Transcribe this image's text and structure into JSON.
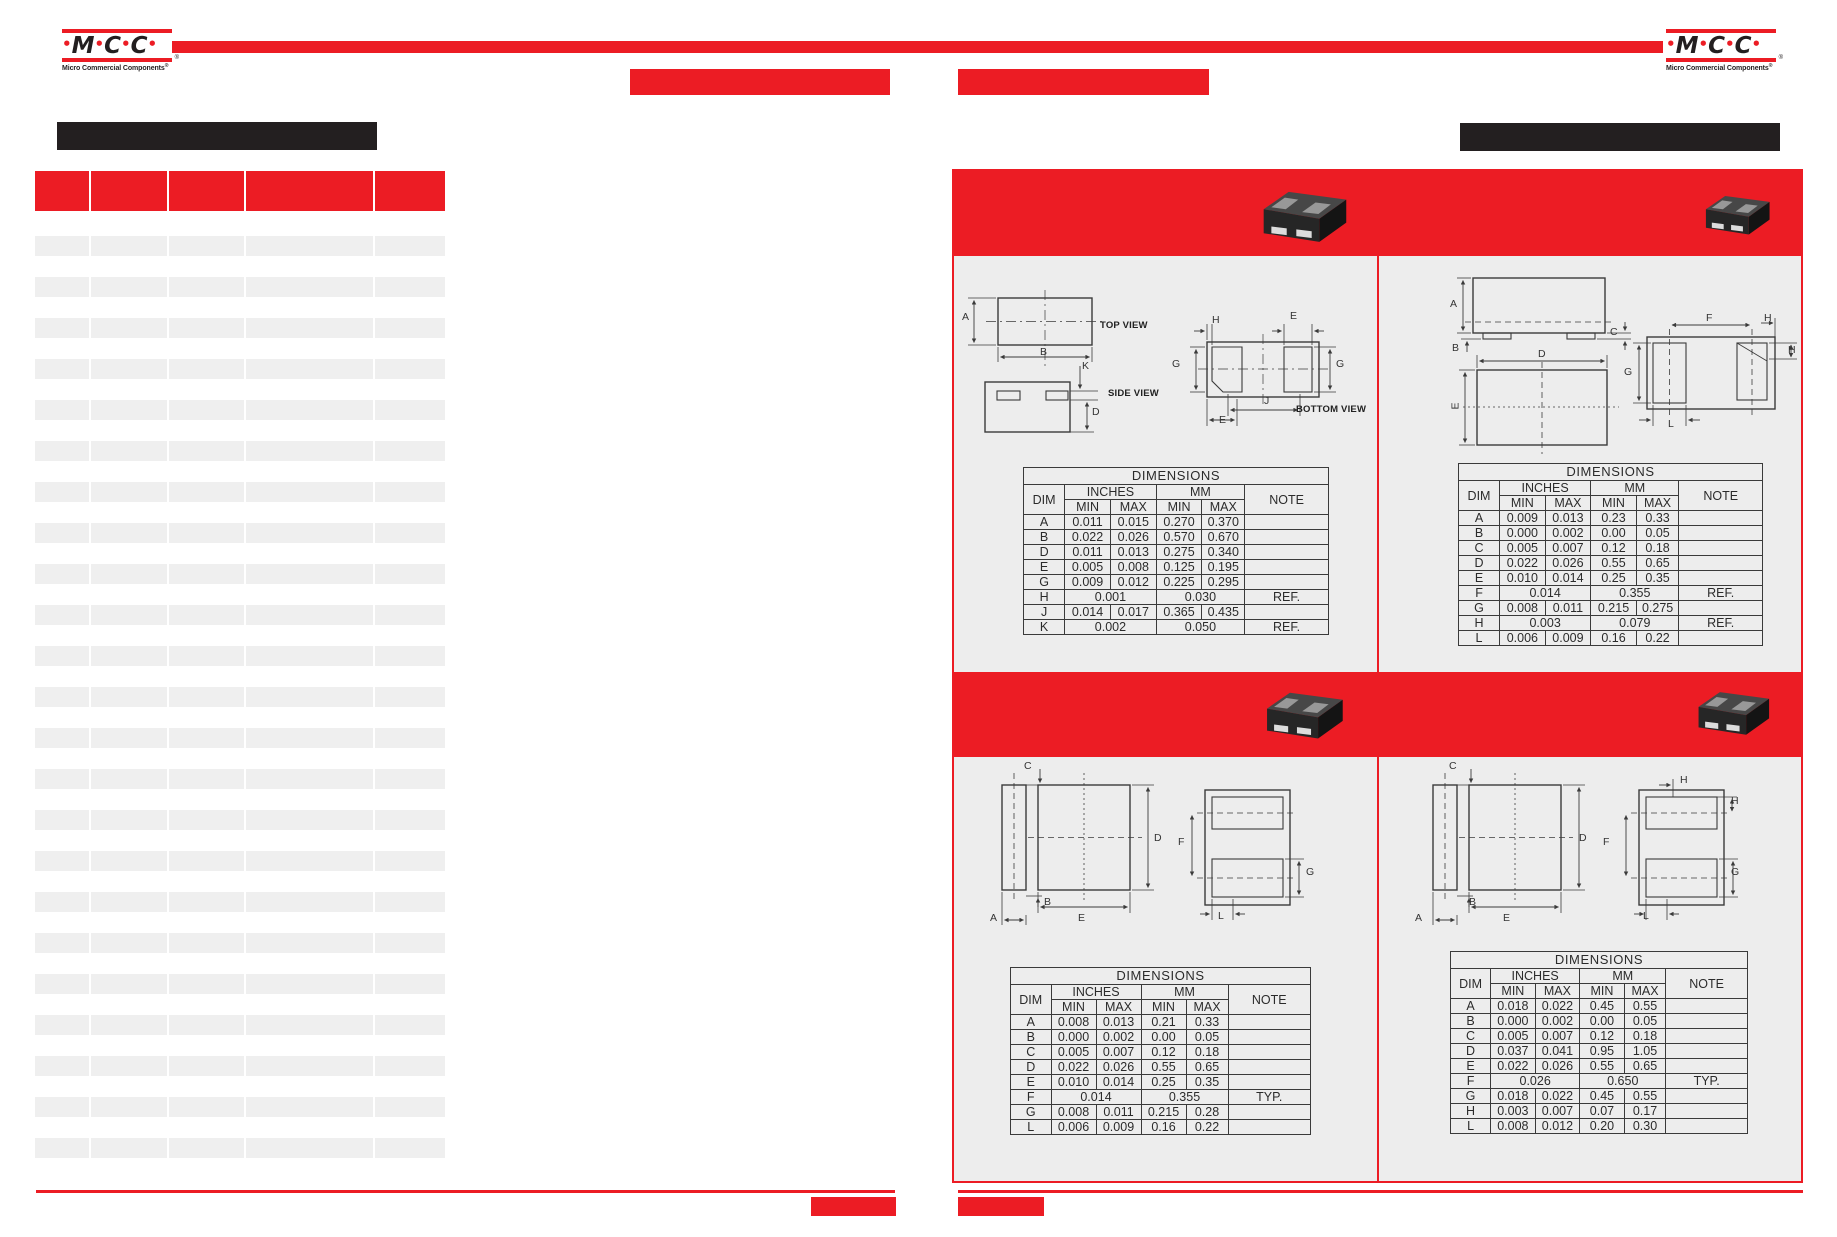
{
  "brand": {
    "wordmark": [
      {
        "t": "•",
        "red": 1
      },
      {
        "t": "M"
      },
      {
        "t": "•",
        "red": 1
      },
      {
        "t": "C"
      },
      {
        "t": "•",
        "red": 1
      },
      {
        "t": "C"
      },
      {
        "t": "•",
        "red": 1
      }
    ],
    "tagline": "Micro Commercial Components",
    "reg": "®"
  },
  "left_table": {
    "row_count": 23,
    "columns": 5
  },
  "dims_tables": {
    "q1": {
      "title": "DIMENSIONS",
      "dim_header": "DIM",
      "group_headers": [
        "INCHES",
        "MM"
      ],
      "sub_headers": [
        "MIN",
        "MAX",
        "MIN",
        "MAX"
      ],
      "note_header": "NOTE",
      "rows": [
        {
          "dim": "A",
          "inches": [
            "0.011",
            "0.015"
          ],
          "mm": [
            "0.270",
            "0.370"
          ],
          "note": ""
        },
        {
          "dim": "B",
          "inches": [
            "0.022",
            "0.026"
          ],
          "mm": [
            "0.570",
            "0.670"
          ],
          "note": ""
        },
        {
          "dim": "D",
          "inches": [
            "0.011",
            "0.013"
          ],
          "mm": [
            "0.275",
            "0.340"
          ],
          "note": ""
        },
        {
          "dim": "E",
          "inches": [
            "0.005",
            "0.008"
          ],
          "mm": [
            "0.125",
            "0.195"
          ],
          "note": ""
        },
        {
          "dim": "G",
          "inches": [
            "0.009",
            "0.012"
          ],
          "mm": [
            "0.225",
            "0.295"
          ],
          "note": ""
        },
        {
          "dim": "H",
          "inches_span": "0.001",
          "mm_span": "0.030",
          "note": "REF."
        },
        {
          "dim": "J",
          "inches": [
            "0.014",
            "0.017"
          ],
          "mm": [
            "0.365",
            "0.435"
          ],
          "note": ""
        },
        {
          "dim": "K",
          "inches_span": "0.002",
          "mm_span": "0.050",
          "note": "REF."
        }
      ]
    },
    "q2": {
      "title": "DIMENSIONS",
      "dim_header": "DIM",
      "group_headers": [
        "INCHES",
        "MM"
      ],
      "sub_headers": [
        "MIN",
        "MAX",
        "MIN",
        "MAX"
      ],
      "note_header": "NOTE",
      "rows": [
        {
          "dim": "A",
          "inches": [
            "0.009",
            "0.013"
          ],
          "mm": [
            "0.23",
            "0.33"
          ],
          "note": ""
        },
        {
          "dim": "B",
          "inches": [
            "0.000",
            "0.002"
          ],
          "mm": [
            "0.00",
            "0.05"
          ],
          "note": ""
        },
        {
          "dim": "C",
          "inches": [
            "0.005",
            "0.007"
          ],
          "mm": [
            "0.12",
            "0.18"
          ],
          "note": ""
        },
        {
          "dim": "D",
          "inches": [
            "0.022",
            "0.026"
          ],
          "mm": [
            "0.55",
            "0.65"
          ],
          "note": ""
        },
        {
          "dim": "E",
          "inches": [
            "0.010",
            "0.014"
          ],
          "mm": [
            "0.25",
            "0.35"
          ],
          "note": ""
        },
        {
          "dim": "F",
          "inches_span": "0.014",
          "mm_span": "0.355",
          "note": "REF."
        },
        {
          "dim": "G",
          "inches": [
            "0.008",
            "0.011"
          ],
          "mm": [
            "0.215",
            "0.275"
          ],
          "note": ""
        },
        {
          "dim": "H",
          "inches_span": "0.003",
          "mm_span": "0.079",
          "note": "REF."
        },
        {
          "dim": "L",
          "inches": [
            "0.006",
            "0.009"
          ],
          "mm": [
            "0.16",
            "0.22"
          ],
          "note": ""
        }
      ]
    },
    "q3": {
      "title": "DIMENSIONS",
      "dim_header": "DIM",
      "group_headers": [
        "INCHES",
        "MM"
      ],
      "sub_headers": [
        "MIN",
        "MAX",
        "MIN",
        "MAX"
      ],
      "note_header": "NOTE",
      "rows": [
        {
          "dim": "A",
          "inches": [
            "0.008",
            "0.013"
          ],
          "mm": [
            "0.21",
            "0.33"
          ],
          "note": ""
        },
        {
          "dim": "B",
          "inches": [
            "0.000",
            "0.002"
          ],
          "mm": [
            "0.00",
            "0.05"
          ],
          "note": ""
        },
        {
          "dim": "C",
          "inches": [
            "0.005",
            "0.007"
          ],
          "mm": [
            "0.12",
            "0.18"
          ],
          "note": ""
        },
        {
          "dim": "D",
          "inches": [
            "0.022",
            "0.026"
          ],
          "mm": [
            "0.55",
            "0.65"
          ],
          "note": ""
        },
        {
          "dim": "E",
          "inches": [
            "0.010",
            "0.014"
          ],
          "mm": [
            "0.25",
            "0.35"
          ],
          "note": ""
        },
        {
          "dim": "F",
          "inches_span": "0.014",
          "mm_span": "0.355",
          "note": "TYP."
        },
        {
          "dim": "G",
          "inches": [
            "0.008",
            "0.011"
          ],
          "mm": [
            "0.215",
            "0.28"
          ],
          "note": ""
        },
        {
          "dim": "L",
          "inches": [
            "0.006",
            "0.009"
          ],
          "mm": [
            "0.16",
            "0.22"
          ],
          "note": ""
        }
      ]
    },
    "q4": {
      "title": "DIMENSIONS",
      "dim_header": "DIM",
      "group_headers": [
        "INCHES",
        "MM"
      ],
      "sub_headers": [
        "MIN",
        "MAX",
        "MIN",
        "MAX"
      ],
      "note_header": "NOTE",
      "rows": [
        {
          "dim": "A",
          "inches": [
            "0.018",
            "0.022"
          ],
          "mm": [
            "0.45",
            "0.55"
          ],
          "note": ""
        },
        {
          "dim": "B",
          "inches": [
            "0.000",
            "0.002"
          ],
          "mm": [
            "0.00",
            "0.05"
          ],
          "note": ""
        },
        {
          "dim": "C",
          "inches": [
            "0.005",
            "0.007"
          ],
          "mm": [
            "0.12",
            "0.18"
          ],
          "note": ""
        },
        {
          "dim": "D",
          "inches": [
            "0.037",
            "0.041"
          ],
          "mm": [
            "0.95",
            "1.05"
          ],
          "note": ""
        },
        {
          "dim": "E",
          "inches": [
            "0.022",
            "0.026"
          ],
          "mm": [
            "0.55",
            "0.65"
          ],
          "note": ""
        },
        {
          "dim": "F",
          "inches_span": "0.026",
          "mm_span": "0.650",
          "note": "TYP."
        },
        {
          "dim": "G",
          "inches": [
            "0.018",
            "0.022"
          ],
          "mm": [
            "0.45",
            "0.55"
          ],
          "note": ""
        },
        {
          "dim": "H",
          "inches": [
            "0.003",
            "0.007"
          ],
          "mm": [
            "0.07",
            "0.17"
          ],
          "note": ""
        },
        {
          "dim": "L",
          "inches": [
            "0.008",
            "0.012"
          ],
          "mm": [
            "0.20",
            "0.30"
          ],
          "note": ""
        }
      ]
    }
  },
  "drawing_labels": {
    "q1": [
      {
        "t": "A",
        "x": 962,
        "y": 311
      },
      {
        "t": "B",
        "x": 1040,
        "y": 346
      },
      {
        "t": "TOP VIEW",
        "x": 1100,
        "y": 320,
        "v": 1
      },
      {
        "t": "K",
        "x": 1082,
        "y": 360
      },
      {
        "t": "D",
        "x": 1092,
        "y": 406
      },
      {
        "t": "SIDE VIEW",
        "x": 1108,
        "y": 388,
        "v": 1
      },
      {
        "t": "H",
        "x": 1212,
        "y": 314
      },
      {
        "t": "E",
        "x": 1290,
        "y": 310
      },
      {
        "t": "G",
        "x": 1172,
        "y": 358
      },
      {
        "t": "G",
        "x": 1336,
        "y": 358
      },
      {
        "t": "J",
        "x": 1264,
        "y": 395
      },
      {
        "t": "E",
        "x": 1219,
        "y": 414
      },
      {
        "t": "BOTTOM VIEW",
        "x": 1296,
        "y": 404,
        "v": 1
      }
    ],
    "q2": [
      {
        "t": "A",
        "x": 1450,
        "y": 298
      },
      {
        "t": "B",
        "x": 1452,
        "y": 342
      },
      {
        "t": "C",
        "x": 1610,
        "y": 326
      },
      {
        "t": "D",
        "x": 1538,
        "y": 348
      },
      {
        "t": "E",
        "x": 1452,
        "y": 400,
        "r": -90
      },
      {
        "t": "F",
        "x": 1706,
        "y": 312
      },
      {
        "t": "H",
        "x": 1764,
        "y": 312
      },
      {
        "t": "H",
        "x": 1788,
        "y": 344
      },
      {
        "t": "G",
        "x": 1624,
        "y": 366
      },
      {
        "t": "L",
        "x": 1668,
        "y": 418
      }
    ],
    "q3": [
      {
        "t": "C",
        "x": 1024,
        "y": 760
      },
      {
        "t": "D",
        "x": 1154,
        "y": 832
      },
      {
        "t": "E",
        "x": 1078,
        "y": 912
      },
      {
        "t": "A",
        "x": 990,
        "y": 912
      },
      {
        "t": "B",
        "x": 1044,
        "y": 896
      },
      {
        "t": "F",
        "x": 1178,
        "y": 836
      },
      {
        "t": "G",
        "x": 1306,
        "y": 866
      },
      {
        "t": "L",
        "x": 1218,
        "y": 910
      }
    ],
    "q4": [
      {
        "t": "C",
        "x": 1449,
        "y": 760
      },
      {
        "t": "D",
        "x": 1579,
        "y": 832
      },
      {
        "t": "E",
        "x": 1503,
        "y": 912
      },
      {
        "t": "A",
        "x": 1415,
        "y": 912
      },
      {
        "t": "B",
        "x": 1469,
        "y": 896
      },
      {
        "t": "H",
        "x": 1680,
        "y": 774
      },
      {
        "t": "H",
        "x": 1731,
        "y": 795
      },
      {
        "t": "F",
        "x": 1603,
        "y": 836
      },
      {
        "t": "G",
        "x": 1731,
        "y": 866
      },
      {
        "t": "L",
        "x": 1643,
        "y": 910
      }
    ]
  }
}
